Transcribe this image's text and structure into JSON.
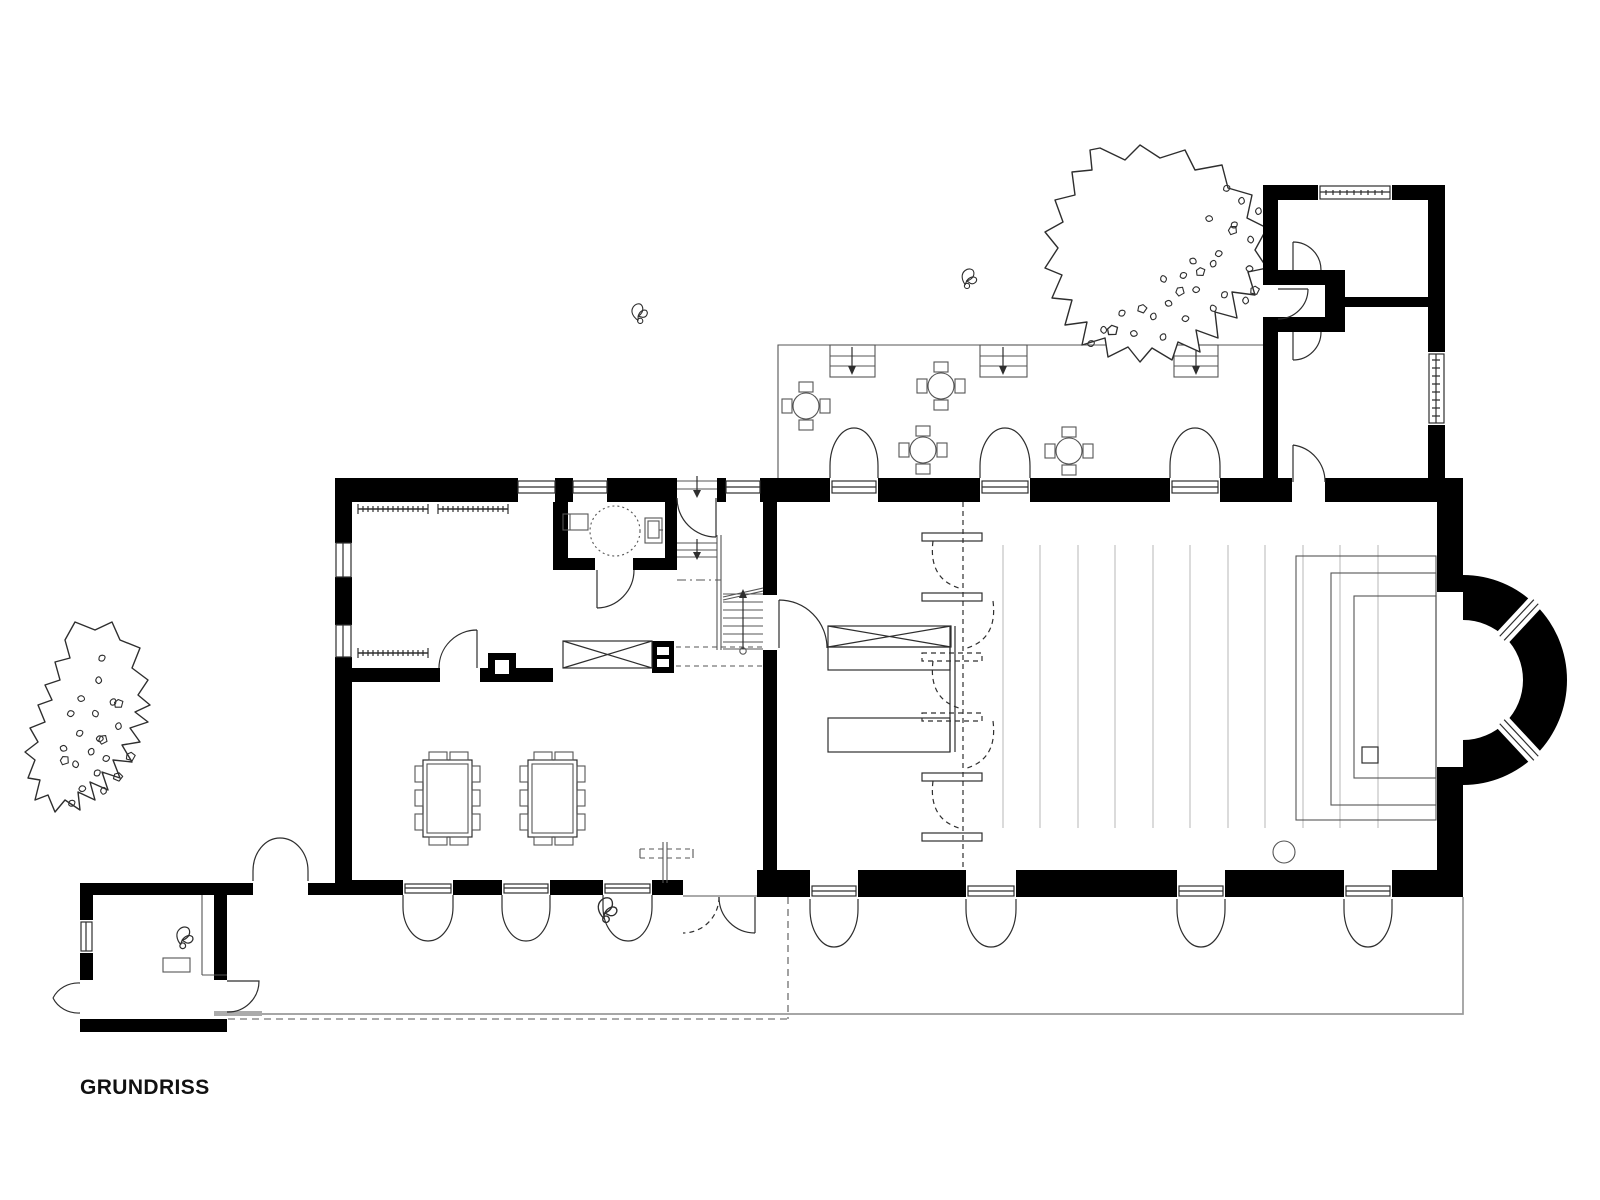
{
  "plan": {
    "title": "GRUNDRISS"
  },
  "colors": {
    "background": "#ffffff",
    "wall": "#000000",
    "line": "#2e2e2e",
    "thinline": "#555555",
    "lightline": "#c3c3c3",
    "siteline": "#9a9a9a"
  },
  "legend": {
    "trees": 2,
    "terrace_round_tables": 4,
    "terrace_stairs": 3,
    "terrace_double_doors": 3,
    "hall_south_double_doors": 4,
    "annex_south_double_doors": 3,
    "garden_gate_double_doors": 1,
    "dining_tables": 2,
    "coat_rails": 3,
    "folding_partition_benches": 6,
    "hall_floor_lines": 11,
    "apse_windows": 2,
    "plant_sprigs": 4
  }
}
